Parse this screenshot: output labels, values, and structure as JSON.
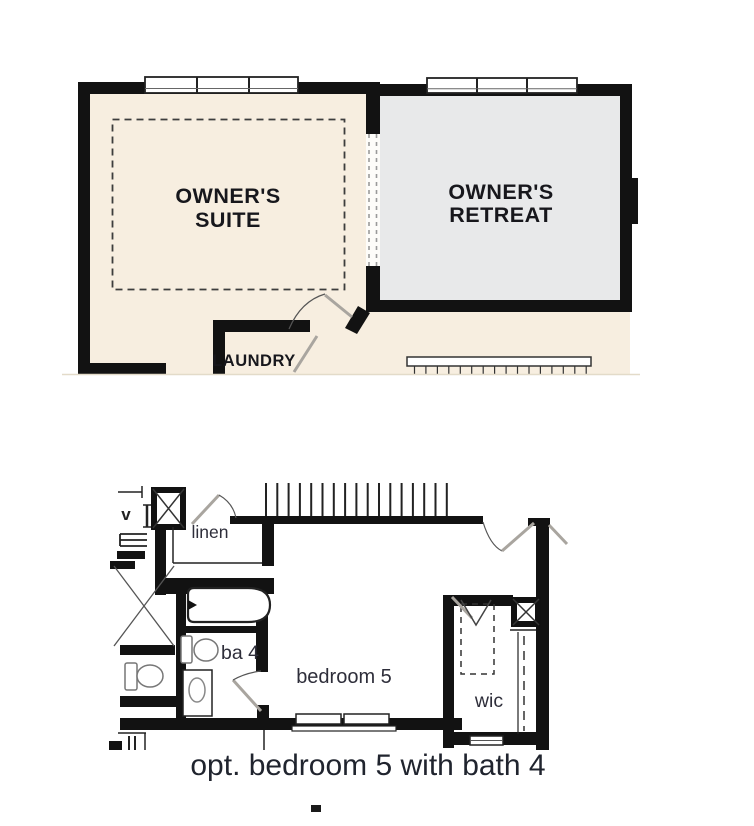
{
  "colors": {
    "page_bg": "#ffffff",
    "suite_floor": "#f7eee0",
    "retreat_floor": "#e8e9ea",
    "wall": "#121212",
    "door_leaf": "#a9a59f",
    "label_dark": "#17171c",
    "label_navy": "#2e2e3a",
    "caption": "#20242e"
  },
  "main_level_plan": {
    "rooms": {
      "owners_suite": {
        "line1": "OWNER'S",
        "line2": "SUITE"
      },
      "owners_retreat": {
        "line1": "OWNER'S",
        "line2": "RETREAT"
      },
      "laundry": {
        "label": "LAUNDRY"
      }
    }
  },
  "optional_plan": {
    "rooms": {
      "linen": {
        "label": "linen"
      },
      "bath4": {
        "label": "ba 4"
      },
      "bedroom5": {
        "label": "bedroom 5"
      },
      "wic": {
        "label": "wic"
      }
    },
    "vent_label": "v",
    "caption": "opt. bedroom 5 with bath 4"
  }
}
